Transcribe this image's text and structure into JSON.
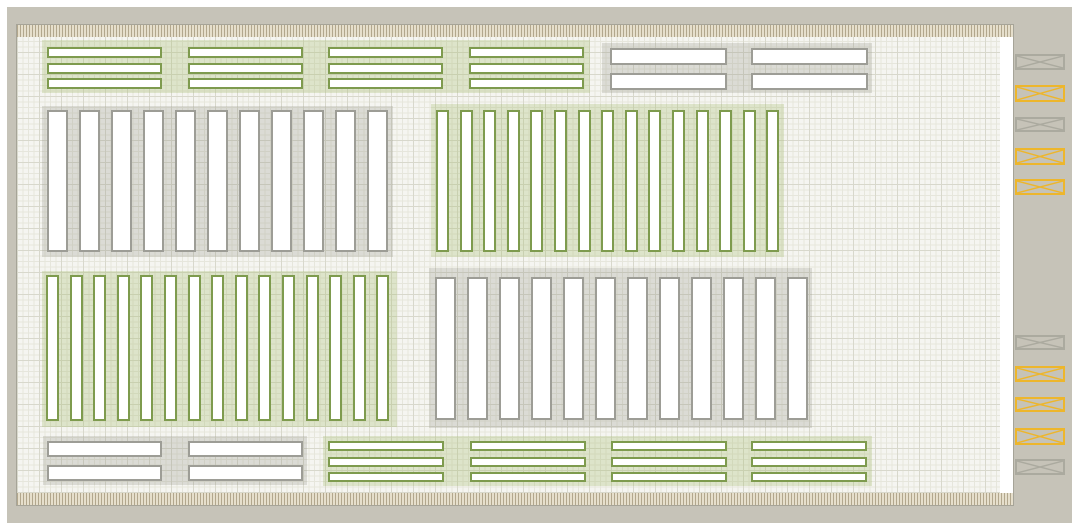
{
  "palette": {
    "wall": "#c6c3b8",
    "floor": "#f5f5f1",
    "grid_minor": "#e6e6dc",
    "grid_major": "#d8d8cc",
    "dock_strip_light": "#e6dfcc",
    "dock_strip_dark": "#b2a78d",
    "rack_green_outline": "#7e9b4e",
    "rack_green_tint": "rgba(167,190,112,0.30)",
    "rack_gray_outline": "#9d9d96",
    "rack_gray_tint": "rgba(150,150,140,0.28)",
    "door_yellow": "#edb62c",
    "door_gray": "#abaa9f",
    "bar_fill": "#ffffff"
  },
  "floor_plan": {
    "building": {
      "x": 7,
      "y": 7,
      "w": 1065,
      "h": 516
    },
    "floor": {
      "x": 17,
      "y": 25,
      "w": 996,
      "h": 480
    },
    "groups": [
      {
        "id": "rack-top-green",
        "scheme": "green",
        "orientation": "h",
        "x": 42,
        "y": 40,
        "w": 548,
        "h": 53,
        "cols": [
          47,
          188,
          328,
          469
        ],
        "col_w": 115,
        "rows": [
          47,
          63,
          78
        ],
        "row_h": 11
      },
      {
        "id": "rack-top-gray",
        "scheme": "gray",
        "orientation": "h",
        "x": 602,
        "y": 43,
        "w": 270,
        "h": 50,
        "cols": [
          610,
          751
        ],
        "col_w": 117,
        "rows": [
          48,
          73
        ],
        "row_h": 17
      },
      {
        "id": "rack-mid-left-gray",
        "scheme": "gray",
        "orientation": "v",
        "x": 42,
        "y": 106,
        "w": 351,
        "h": 151,
        "count": 11,
        "first": 47,
        "pitch": 32,
        "bar_w": 21,
        "bar_y": 110,
        "bar_h": 142
      },
      {
        "id": "rack-mid-right-green",
        "scheme": "green",
        "orientation": "v",
        "x": 431,
        "y": 104,
        "w": 353,
        "h": 153,
        "count": 15,
        "first": 436,
        "pitch": 23.6,
        "bar_w": 13,
        "bar_y": 110,
        "bar_h": 142
      },
      {
        "id": "rack-low-left-green",
        "scheme": "green",
        "orientation": "v",
        "x": 42,
        "y": 271,
        "w": 355,
        "h": 156,
        "count": 15,
        "first": 46,
        "pitch": 23.6,
        "bar_w": 13,
        "bar_y": 275,
        "bar_h": 146
      },
      {
        "id": "rack-low-right-gray",
        "scheme": "gray",
        "orientation": "v",
        "x": 429,
        "y": 268,
        "w": 383,
        "h": 160,
        "count": 12,
        "first": 435,
        "pitch": 32,
        "bar_w": 21,
        "bar_y": 277,
        "bar_h": 143
      },
      {
        "id": "rack-bottom-gray",
        "scheme": "gray",
        "orientation": "h",
        "x": 43,
        "y": 436,
        "w": 264,
        "h": 49,
        "cols": [
          47,
          188
        ],
        "col_w": 115,
        "rows": [
          441,
          465
        ],
        "row_h": 16
      },
      {
        "id": "rack-bottom-green",
        "scheme": "green",
        "orientation": "h",
        "x": 323,
        "y": 436,
        "w": 549,
        "h": 50,
        "cols": [
          328,
          470,
          611,
          751
        ],
        "col_w": 116,
        "rows": [
          441,
          457,
          472
        ],
        "row_h": 10
      }
    ],
    "dock_doors": [
      {
        "x": 1015,
        "y": 54,
        "w": 50,
        "h": 16,
        "color": "gray"
      },
      {
        "x": 1015,
        "y": 85,
        "w": 50,
        "h": 17,
        "color": "yellow"
      },
      {
        "x": 1015,
        "y": 117,
        "w": 50,
        "h": 15,
        "color": "gray"
      },
      {
        "x": 1015,
        "y": 148,
        "w": 50,
        "h": 17,
        "color": "yellow"
      },
      {
        "x": 1015,
        "y": 179,
        "w": 50,
        "h": 16,
        "color": "yellow"
      },
      {
        "x": 1015,
        "y": 335,
        "w": 50,
        "h": 15,
        "color": "gray"
      },
      {
        "x": 1015,
        "y": 366,
        "w": 50,
        "h": 16,
        "color": "yellow"
      },
      {
        "x": 1015,
        "y": 397,
        "w": 50,
        "h": 15,
        "color": "yellow"
      },
      {
        "x": 1015,
        "y": 428,
        "w": 50,
        "h": 17,
        "color": "yellow"
      },
      {
        "x": 1015,
        "y": 459,
        "w": 50,
        "h": 16,
        "color": "gray"
      }
    ]
  }
}
